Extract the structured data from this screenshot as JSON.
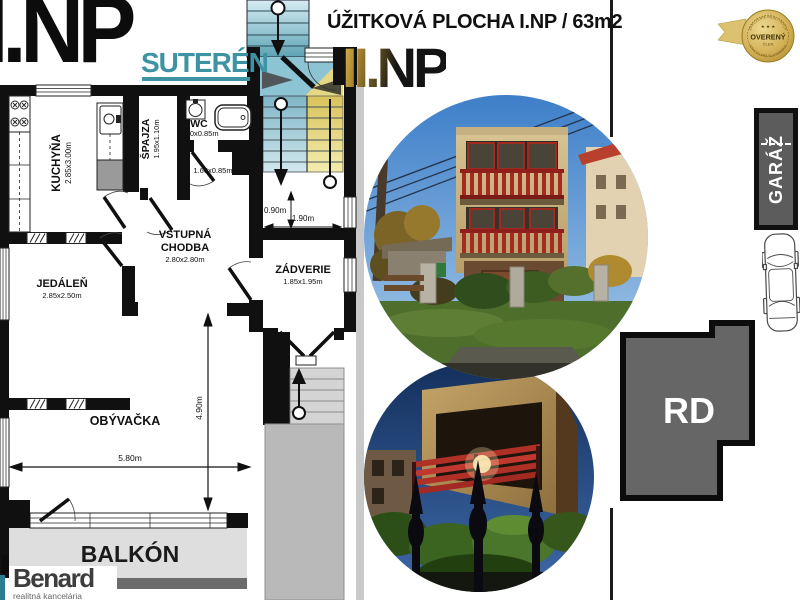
{
  "header": {
    "left_floor": "I.NP",
    "suteren": "SUTERÉN",
    "right_floor": "II.NP",
    "title": "ÚŽITKOVÁ PLOCHA I.NP / 63m2"
  },
  "badge": {
    "stars": "★ ★ ★",
    "line1": "OVERENÝ",
    "line2": "ČLEN",
    "arc_top": "ZDRUŽENIE REALITNÝCH",
    "arc_bottom": "KANCELÁRIÍ SLOVENSKA"
  },
  "plan": {
    "kuchyna": "KUCHYŇA",
    "kuchyna_dim": "2.85x3.00m",
    "spajza": "ŠPAJZA",
    "spajza_dim": "1.95x1.10m",
    "wc": "WC",
    "wc_dim": "1.60x0.85m",
    "nika_dim": "1.60x0.85m",
    "vstupna_1": "VSTUPNÁ",
    "vstupna_2": "CHODBA",
    "vstupna_dim": "2.80x2.80m",
    "zadverie": "ZÁDVERIE",
    "zadverie_dim": "1.85x1.95m",
    "jedalen": "JEDÁLEŇ",
    "jedalen_dim": "2.85x2.50m",
    "obyvacka": "OBÝVAČKA",
    "balkon": "BALKÓN",
    "dim_width": "5.80m",
    "dim_height": "4.90m",
    "dim_landing": "0.90m",
    "dim_stairs": "1.90m"
  },
  "right_panel": {
    "garage": "GARÁŽ",
    "rd": "RD"
  },
  "logo": {
    "name": "Benard",
    "tagline": "realitná kancelária"
  },
  "colors": {
    "suteren_teal": "#3d93a3",
    "gold": "#c9a227",
    "wall": "#111111",
    "garage_gray": "#5c5c5c",
    "rd_gray": "#666666",
    "balcony_gray": "#dedede"
  }
}
